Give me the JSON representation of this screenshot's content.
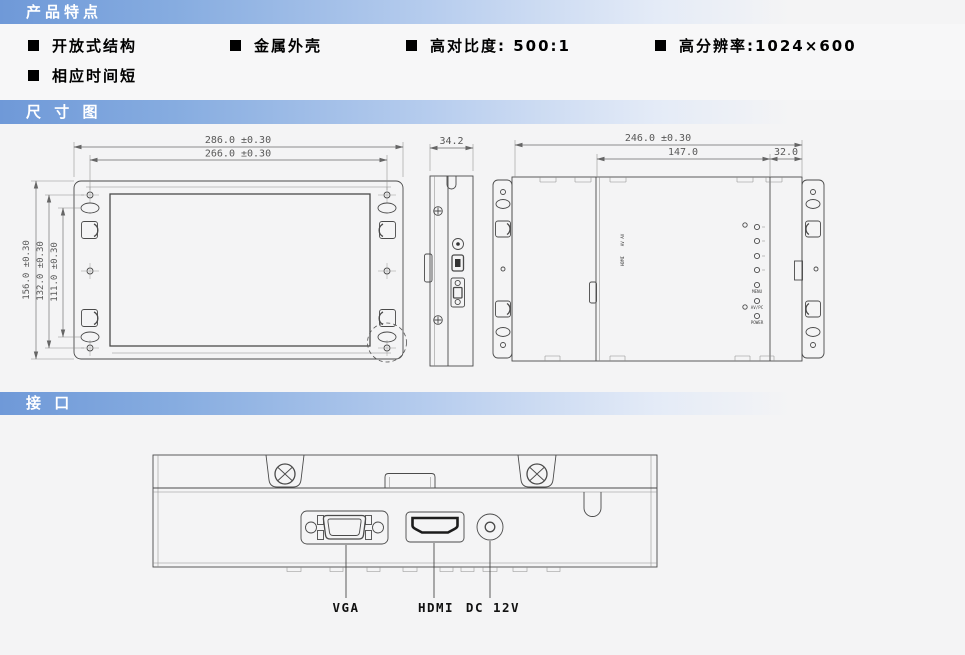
{
  "header_bars": {
    "features": "产品特点",
    "dimensions": "尺 寸 图",
    "interface": "接 口"
  },
  "features": {
    "items": [
      "开放式结构",
      "金属外壳",
      "高对比度: 500:1",
      "高分辨率:1024×600",
      "相应时间短"
    ]
  },
  "dimension_diagram": {
    "front_view": {
      "width_outer": "286.0 ±0.30",
      "width_holes": "266.0 ±0.30",
      "height_outer": "156.0 ±0.30",
      "height_holes": "132.0 ±0.30",
      "height_slots": "111.0 ±0.30"
    },
    "side_view": {
      "depth": "34.2"
    },
    "rear_view": {
      "width_outer": "246.0 ±0.30",
      "width_center": "147.0",
      "width_edge": "32.0",
      "button_labels": [
        "MENU",
        "AV/PC",
        "POWER"
      ],
      "port_labels": [
        "AV AV",
        "HDMI"
      ]
    }
  },
  "interface_diagram": {
    "port_labels": [
      "VGA",
      "HDMI",
      "DC 12V"
    ]
  },
  "colors": {
    "bar_accent": "#6f99d8",
    "line": "#4a4a4a",
    "dim_text": "#585858"
  }
}
